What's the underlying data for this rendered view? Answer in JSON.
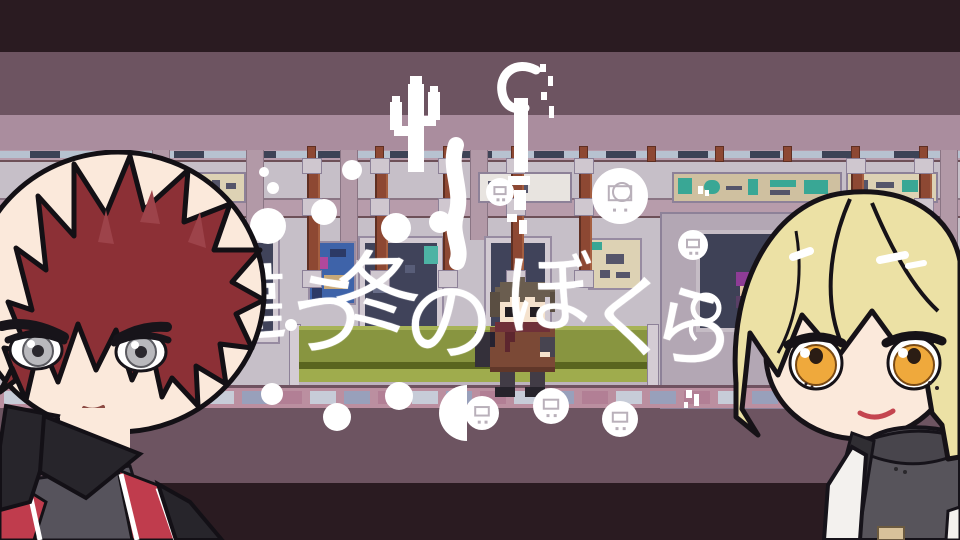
{
  "title": {
    "text": "違う冬のぼくら",
    "color": "#ffffff"
  },
  "scene": {
    "setting_colors": {
      "band_dark": "#2a1b21",
      "band_mid": "#6d5461",
      "band_light": "#aa8d9e",
      "wall": "#c6bfc8",
      "window": "#40435a",
      "pole": "#8d4833",
      "bench_green": "#889540",
      "floor": "#bb8fa0",
      "decoration_white": "#ffffff"
    }
  },
  "decorations": {
    "icons": [
      "pixel-cactus-icon",
      "robot-claw-icon",
      "robot-badge-icon",
      "washing-machine-badge-icon",
      "sparkle-dot-icon",
      "half-circle-icon",
      "ring-icon"
    ]
  },
  "characters": {
    "left_hair_color": "#8c3036",
    "left_eye_color": "#b9b9bd",
    "left_vest_color": "#c03c4d",
    "right_hair_color": "#ece1a5",
    "right_eye_color": "#efa93c",
    "sprite_coat_color": "#7b4936"
  }
}
